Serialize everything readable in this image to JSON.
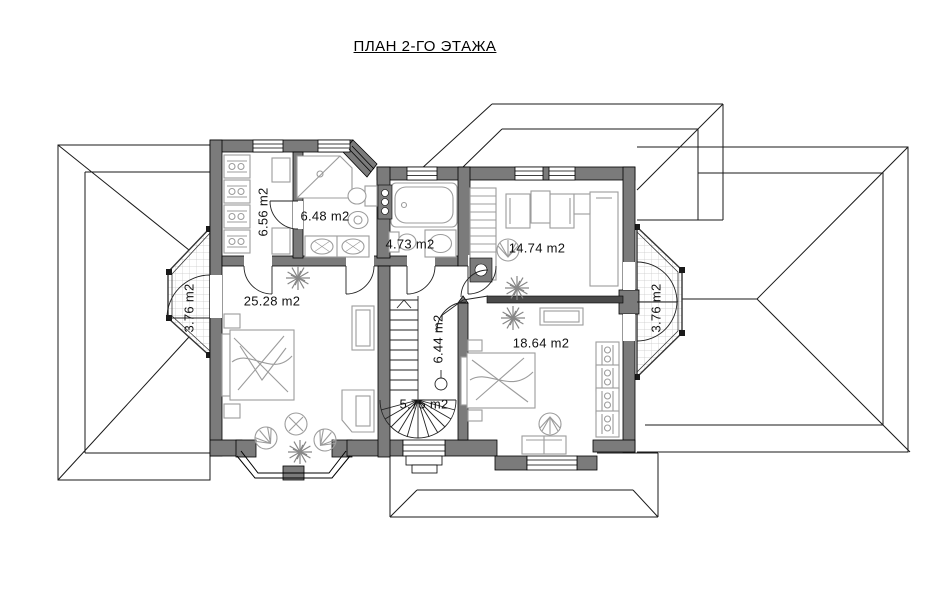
{
  "title": "ПЛАН 2-ГО ЭТАЖА",
  "rooms": {
    "closet": {
      "area_label": "6.56 m2"
    },
    "bath_big": {
      "area_label": "6.48 m2"
    },
    "bath_small": {
      "area_label": "4.73 m2"
    },
    "study": {
      "area_label": "14.74 m2"
    },
    "bedroom_left": {
      "area_label": "25.28 m2"
    },
    "hall": {
      "area_label": "6.44 m2"
    },
    "stairs": {
      "area_label": "5.75 m2"
    },
    "bedroom_right": {
      "area_label": "18.64 m2"
    },
    "balcony_left": {
      "area_label": "3.76 m2"
    },
    "balcony_right": {
      "area_label": "3.76 m2"
    }
  },
  "colors": {
    "wall": "#7b7b7b",
    "thin_wall": "#4a4a4a",
    "furniture": "#9c9c9c",
    "roof_line": "#1a1a1a",
    "hatch": "#c8c8c8",
    "text": "#111111"
  }
}
